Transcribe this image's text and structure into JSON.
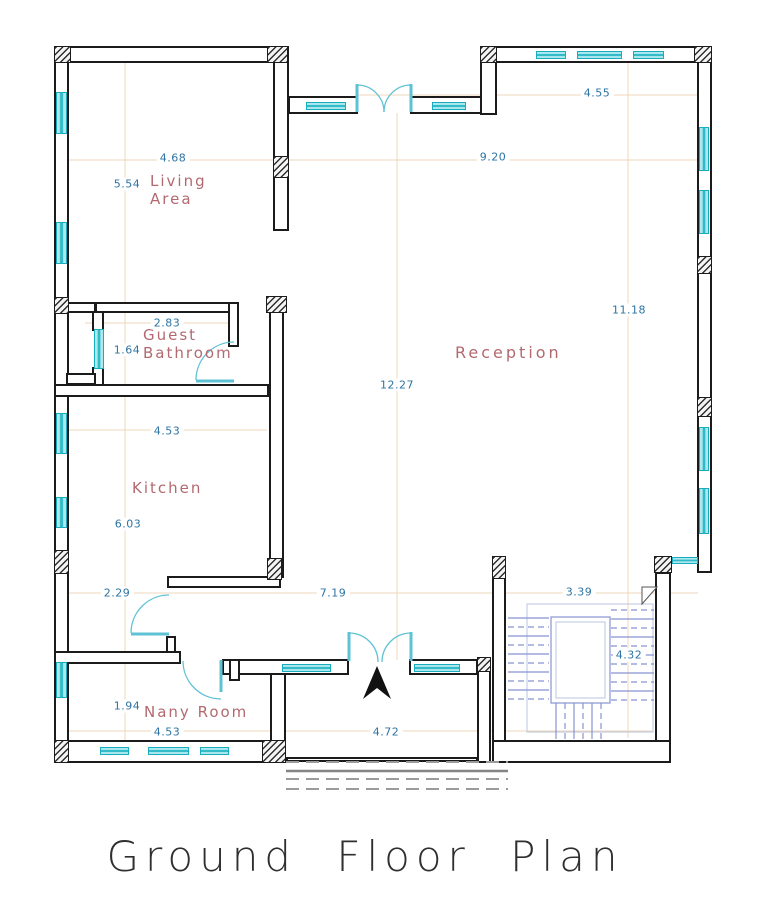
{
  "title": "Ground Floor Plan",
  "rooms": {
    "living": {
      "line1": "Living",
      "line2": "Area"
    },
    "guest_bathroom": {
      "line1": "Guest",
      "line2": "Bathroom"
    },
    "reception": {
      "label": "Reception"
    },
    "kitchen": {
      "label": "Kitchen"
    },
    "nany": {
      "label": "Nany Room"
    }
  },
  "dimensions": {
    "reception_top_width": "4.55",
    "living_width": "4.68",
    "reception_width": "9.20",
    "living_height": "5.54",
    "bathroom_width": "2.83",
    "bathroom_height": "1.64",
    "reception_height_right": "11.18",
    "reception_height": "12.27",
    "kitchen_width": "4.53",
    "kitchen_height": "6.03",
    "hall_left": "2.29",
    "hall_width": "7.19",
    "stair_width": "3.39",
    "stair_height": "4.32",
    "nany_height": "1.94",
    "nany_width": "4.53",
    "porch_width": "4.72"
  },
  "colors": {
    "wall": "#1b1b1b",
    "window_fill": "#2fbac7",
    "window_border": "#18adbc",
    "door": "#5fc2d4",
    "dim_text": "#2d74a4",
    "room_text": "#b2696f",
    "grid_line": "#eed7b8",
    "stair_line": "#8894d2",
    "stair_guard": "#b9c6e2",
    "steps": "#9b9b9b",
    "title_text": "#2f2f2f"
  }
}
